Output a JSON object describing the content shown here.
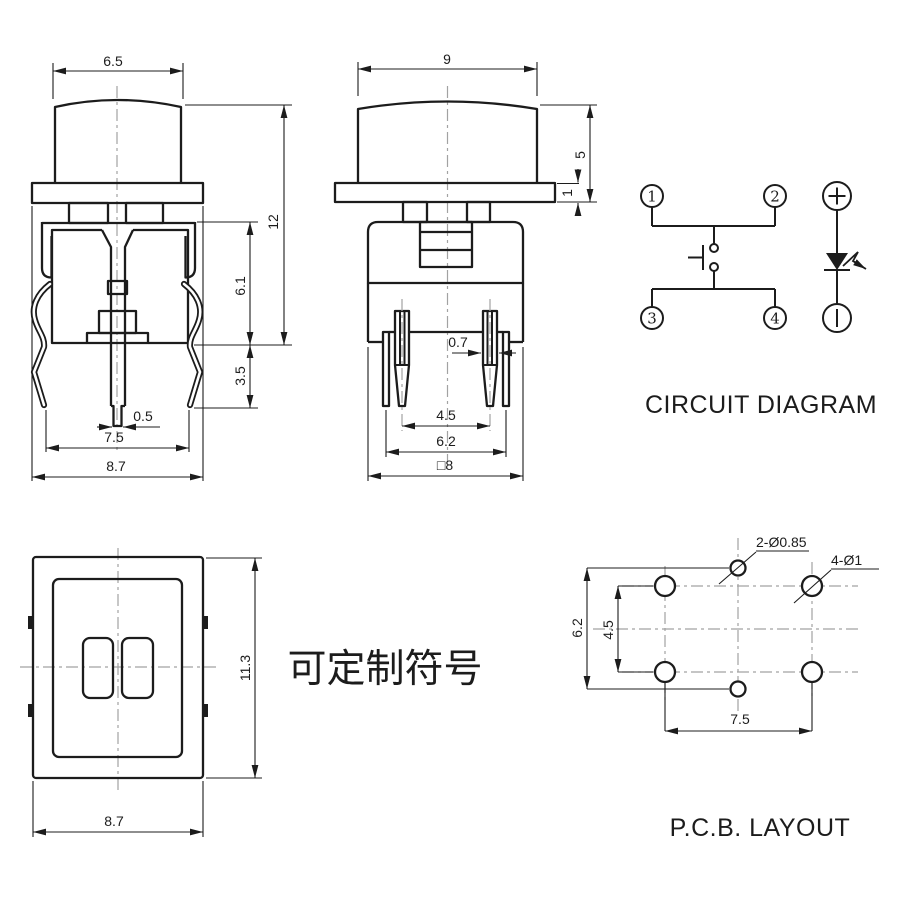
{
  "drawing": {
    "background": "#ffffff",
    "ink": "#1c1c1c",
    "centerline_color": "#a2a2a2"
  },
  "front_view": {
    "dims": {
      "cap_width": "6.5",
      "overall_height": "12",
      "body_height": "6.1",
      "clip_height": "3.5",
      "pin_tip_width": "0.5",
      "foot_span": "7.5",
      "flange_width": "8.7"
    }
  },
  "side_view": {
    "dims": {
      "cap_width": "9",
      "cap_height": "5",
      "flange_thickness": "1",
      "pin_width": "0.7",
      "pin_pitch": "4.5",
      "tab_pitch": "6.2",
      "body_width": "□8"
    }
  },
  "circuit_diagram": {
    "title": "CIRCUIT DIAGRAM",
    "terminals": {
      "t1": "1",
      "t2": "2",
      "t3": "3",
      "t4": "4"
    },
    "polarity": {
      "positive": "+",
      "negative": "−"
    }
  },
  "top_view": {
    "dims": {
      "width": "8.7",
      "height": "11.3"
    },
    "note": "可定制符号"
  },
  "pcb_layout": {
    "title": "P.C.B. LAYOUT",
    "callouts": {
      "small_holes": "2-Ø0.85",
      "large_holes": "4-Ø1"
    },
    "dims": {
      "hole_row_pitch": "6.2",
      "pad_row_pitch": "4.5",
      "pad_col_pitch": "7.5"
    }
  }
}
